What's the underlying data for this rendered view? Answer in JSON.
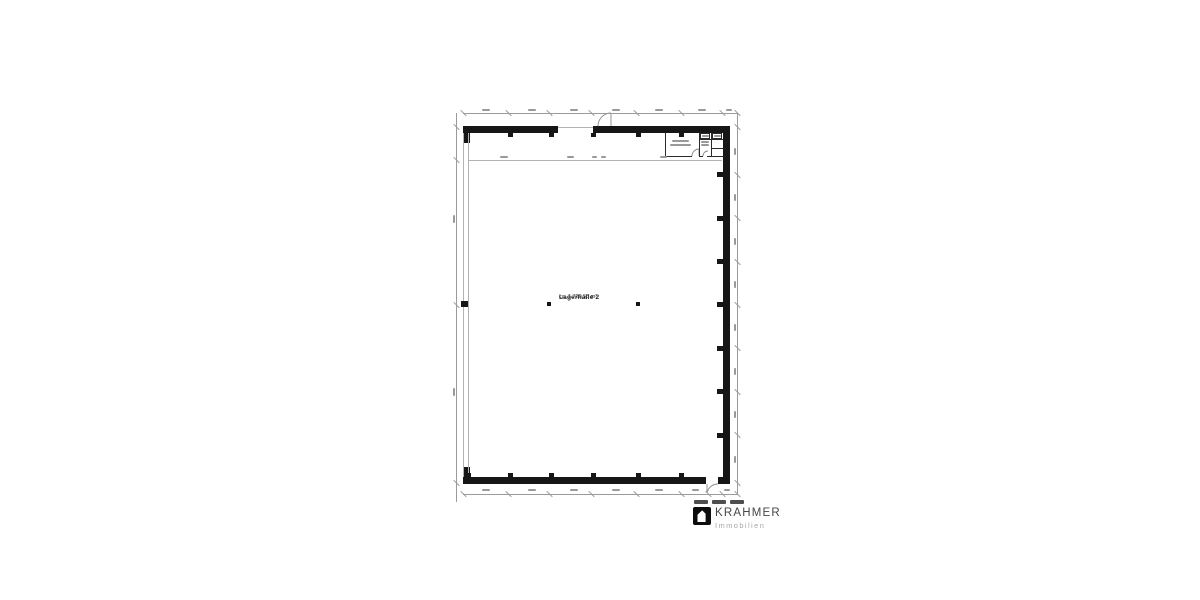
{
  "canvas": {
    "width": 1200,
    "height": 600,
    "background": "#ffffff"
  },
  "floorplan": {
    "hall": {
      "name": "Lagerhalle 2",
      "area": "ca. 1.729,55 m²"
    },
    "colors": {
      "wall": "#161616",
      "thin": "#b3b3b3",
      "rline": "#2a2a2a",
      "dim": "#9b9b9b",
      "smudge": "#999999"
    },
    "geometry": {
      "walls": [
        [
          463,
          126,
          95,
          7
        ],
        [
          593,
          126,
          137,
          7
        ],
        [
          723,
          133,
          7,
          351
        ],
        [
          463,
          477,
          243,
          7
        ],
        [
          718,
          477,
          12,
          7
        ],
        [
          463,
          133,
          7,
          10
        ],
        [
          463,
          467,
          7,
          10
        ]
      ],
      "columns": [
        [
          508,
          133,
          5,
          4
        ],
        [
          549,
          133,
          5,
          4
        ],
        [
          591,
          133,
          5,
          4
        ],
        [
          636,
          133,
          5,
          4
        ],
        [
          679,
          133,
          5,
          4
        ],
        [
          466,
          473,
          5,
          4
        ],
        [
          508,
          473,
          5,
          4
        ],
        [
          549,
          473,
          5,
          4
        ],
        [
          591,
          473,
          5,
          4
        ],
        [
          636,
          473,
          5,
          4
        ],
        [
          679,
          473,
          5,
          4
        ],
        [
          717,
          172,
          6,
          5
        ],
        [
          717,
          216,
          6,
          5
        ],
        [
          717,
          259,
          6,
          5
        ],
        [
          717,
          302,
          6,
          5
        ],
        [
          717,
          346,
          6,
          5
        ],
        [
          717,
          389,
          6,
          5
        ],
        [
          717,
          433,
          6,
          5
        ],
        [
          461,
          301,
          7,
          6
        ],
        [
          547,
          302,
          4,
          4
        ],
        [
          636,
          302,
          4,
          4
        ]
      ],
      "thin": [
        [
          463,
          133,
          1,
          344
        ],
        [
          468,
          133,
          1,
          344
        ],
        [
          558,
          127,
          35,
          1
        ],
        [
          469,
          160,
          253,
          1
        ]
      ],
      "rlines": [
        [
          665,
          133,
          1,
          24
        ],
        [
          665,
          156,
          27,
          1
        ],
        [
          699,
          133,
          1,
          24
        ],
        [
          699,
          156,
          4,
          1
        ],
        [
          707,
          156,
          16,
          1
        ],
        [
          711,
          133,
          1,
          23
        ],
        [
          699,
          139,
          24,
          1
        ],
        [
          711,
          148,
          12,
          1
        ]
      ],
      "boxes": [
        [
          700,
          133,
          10,
          6
        ],
        [
          712,
          133,
          10,
          6
        ]
      ],
      "dims": [
        [
          463,
          113,
          275,
          1
        ],
        [
          463,
          494,
          275,
          1
        ],
        [
          737,
          113,
          1,
          381
        ],
        [
          456,
          113,
          1,
          389
        ]
      ],
      "ticks": [
        [
          463,
          113
        ],
        [
          508,
          113
        ],
        [
          549,
          113
        ],
        [
          591,
          113
        ],
        [
          636,
          113
        ],
        [
          681,
          113
        ],
        [
          722,
          113
        ],
        [
          737,
          113
        ],
        [
          463,
          494
        ],
        [
          508,
          494
        ],
        [
          549,
          494
        ],
        [
          591,
          494
        ],
        [
          636,
          494
        ],
        [
          681,
          494
        ],
        [
          708,
          494
        ],
        [
          722,
          494
        ],
        [
          737,
          494
        ],
        [
          737,
          127
        ],
        [
          737,
          175
        ],
        [
          737,
          218
        ],
        [
          737,
          262
        ],
        [
          737,
          305
        ],
        [
          737,
          348
        ],
        [
          737,
          392
        ],
        [
          737,
          435
        ],
        [
          737,
          483
        ],
        [
          456,
          127
        ],
        [
          456,
          160
        ],
        [
          456,
          305
        ],
        [
          456,
          483
        ]
      ],
      "smudges": [
        [
          482,
          109,
          8,
          2
        ],
        [
          528,
          109,
          8,
          2
        ],
        [
          570,
          109,
          8,
          2
        ],
        [
          612,
          109,
          8,
          2
        ],
        [
          655,
          109,
          8,
          2
        ],
        [
          698,
          109,
          8,
          2
        ],
        [
          726,
          109,
          6,
          2
        ],
        [
          482,
          489,
          8,
          2
        ],
        [
          528,
          489,
          8,
          2
        ],
        [
          570,
          489,
          8,
          2
        ],
        [
          612,
          489,
          8,
          2
        ],
        [
          655,
          489,
          8,
          2
        ],
        [
          692,
          489,
          7,
          2
        ],
        [
          724,
          489,
          6,
          2
        ],
        [
          734,
          148,
          2,
          7
        ],
        [
          734,
          194,
          2,
          7
        ],
        [
          734,
          238,
          2,
          7
        ],
        [
          734,
          281,
          2,
          7
        ],
        [
          734,
          324,
          2,
          7
        ],
        [
          734,
          368,
          2,
          7
        ],
        [
          734,
          411,
          2,
          7
        ],
        [
          734,
          456,
          2,
          7
        ],
        [
          453,
          215,
          2,
          8
        ],
        [
          453,
          388,
          2,
          8
        ],
        [
          500,
          156,
          8,
          2
        ],
        [
          567,
          156,
          7,
          2
        ],
        [
          592,
          156,
          5,
          2
        ],
        [
          601,
          156,
          5,
          2
        ],
        [
          660,
          156,
          7,
          2
        ],
        [
          672,
          140,
          17,
          2
        ],
        [
          670,
          143.5,
          21,
          2
        ],
        [
          702,
          135,
          7,
          1.5
        ],
        [
          714,
          135,
          7,
          1.5
        ],
        [
          701,
          141,
          8,
          1.5
        ],
        [
          701,
          144,
          8,
          1.5
        ]
      ],
      "arcs": [
        "M 598 126 A 13 13 0 0 1 611 113",
        "M 611 113 L 611 127",
        "M 707 484 L 707 493 A 11 11 0 0 1 718 484",
        "M 692 156 A 7 7 0 0 1 699 149 L 699 156",
        "M 703 156 A 5 5 0 0 1 708 151"
      ]
    }
  },
  "footer": {
    "dashes": [
      [
        694,
        500,
        14,
        4
      ],
      [
        712,
        500,
        14,
        4
      ],
      [
        730,
        500,
        14,
        4
      ]
    ],
    "dash_color": "#4e4e4e"
  },
  "branding": {
    "name": "KRAHMER",
    "subtitle": "Immobilien",
    "icon": "door-house-icon",
    "icon_bg": "#0d0d0d",
    "name_color": "#464646",
    "subtitle_color": "#a8a8a8"
  }
}
